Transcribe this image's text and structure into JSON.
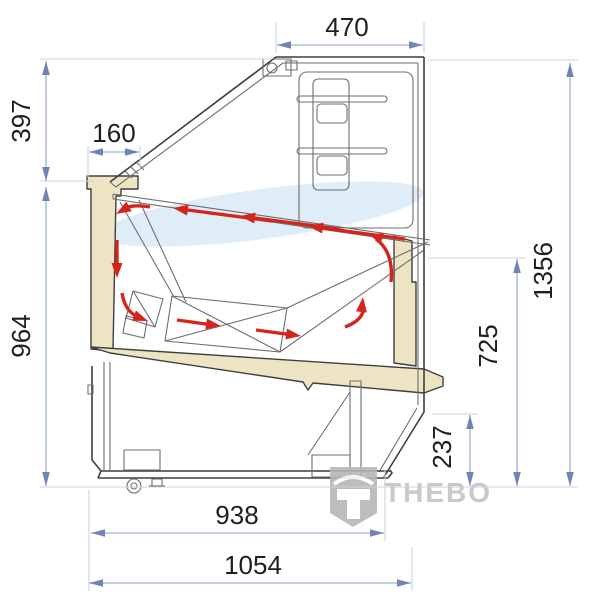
{
  "diagram": {
    "type": "technical-drawing-cross-section",
    "subject": "refrigerated ice-cream display case, side section with airflow",
    "units": "mm",
    "dimensions": {
      "top_width": "470",
      "upper_front_height": "397",
      "front_ledge_depth": "160",
      "lower_front_height": "964",
      "total_height": "1356",
      "rear_worktop_height": "725",
      "rear_recess_height": "237",
      "base_depth": "938",
      "total_depth": "1054"
    },
    "watermark": {
      "brand": "THEBO"
    },
    "airflow_arrow_count": 10,
    "colors": {
      "dimension_line": "#9db3d0",
      "extension_line": "#c9d4e3",
      "dimension_arrow": "#6f85b5",
      "dimension_text": "#1f1f1f",
      "case_outline": "#3f3f3f",
      "insulation_fill": "#ece4c2",
      "glass_tint": "#d9eaf8",
      "airflow_arrow": "#d4251c",
      "watermark_gray": "#c4c4c4"
    }
  }
}
